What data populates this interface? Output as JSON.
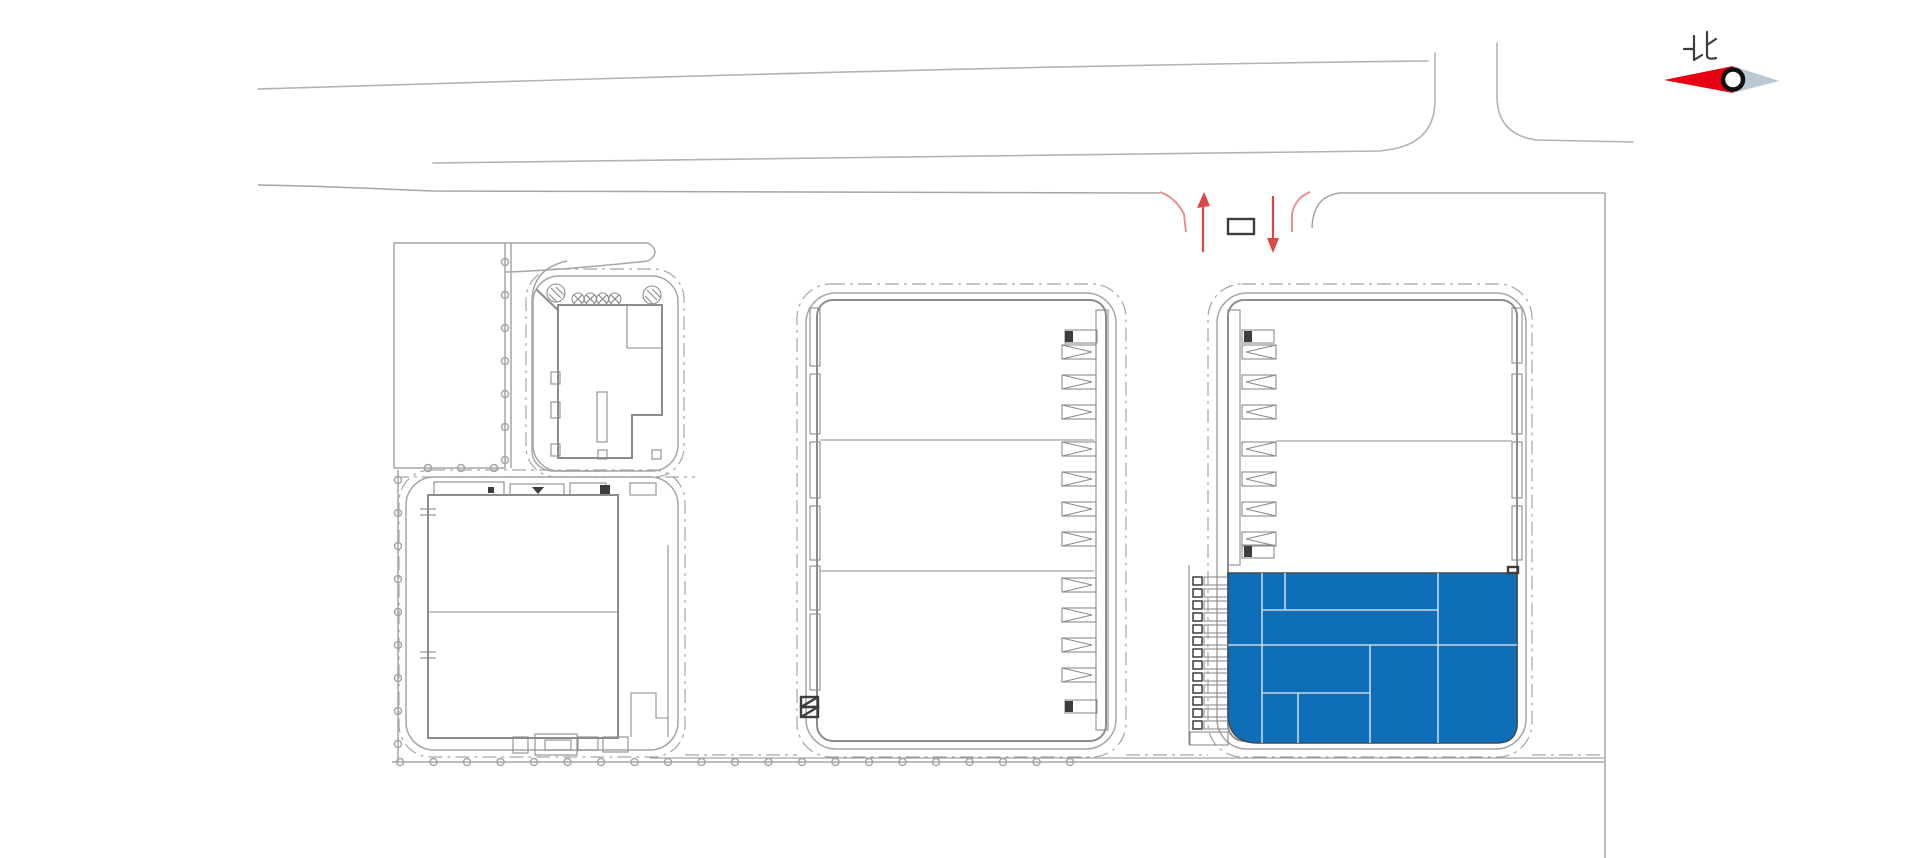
{
  "compass": {
    "north_label": "北"
  },
  "colors": {
    "background": "#ffffff",
    "road_line": "#b3b3b3",
    "boundary_line": "#a6a6a6",
    "wall_line": "#8c8c8c",
    "detail_dark": "#3d3d3d",
    "highlight_fill": "#0e6fb8",
    "highlight_partition": "#c8d8e4",
    "compass_red": "#e60012",
    "compass_gray": "#b9c8d2",
    "entrance_red_arrow": "#d94747",
    "entrance_red_flare": "#ea8f8f"
  },
  "plan": {
    "parking_posts_right": {
      "x": 505,
      "y0": 262,
      "step": 33,
      "count": 7
    },
    "parking_posts_bottom": {
      "y": 468,
      "xs": [
        428,
        461,
        494
      ]
    },
    "left_fence_posts": {
      "x": 398,
      "y0": 480,
      "step": 33,
      "count": 9
    },
    "bottom_fence_posts": {
      "y": 762,
      "x0": 400,
      "step": 33.5,
      "count": 21
    },
    "fans": {
      "y": 299,
      "x0": 578,
      "step": 12.3,
      "count": 4,
      "r": 6
    },
    "mid_wall_strips": [
      [
        810,
        308,
        10,
        58
      ],
      [
        810,
        374,
        10,
        60
      ],
      [
        810,
        442,
        10,
        56
      ],
      [
        810,
        506,
        10,
        54
      ],
      [
        810,
        566,
        10,
        44
      ],
      [
        810,
        614,
        10,
        76
      ]
    ],
    "right_wall_strips": [
      [
        1512,
        308,
        10,
        55
      ],
      [
        1512,
        374,
        10,
        60
      ],
      [
        1512,
        442,
        10,
        56
      ],
      [
        1512,
        506,
        10,
        54
      ]
    ],
    "mid_docks": {
      "x": 1062,
      "w": 34,
      "h": 14,
      "dir": 1,
      "ys": [
        352,
        382,
        412,
        449,
        479,
        509,
        539,
        585,
        615,
        645,
        675
      ]
    },
    "right_docks": {
      "x": 1242,
      "w": 34,
      "h": 14,
      "dir": -1,
      "ys": [
        352,
        382,
        412,
        449,
        479,
        509,
        539
      ]
    },
    "mid_endcaps": [
      [
        1065,
        330
      ],
      [
        1065,
        700
      ]
    ],
    "right_endcaps": [
      [
        1242,
        330
      ],
      [
        1242,
        545
      ]
    ],
    "blue_docks": {
      "x_sq": 1193,
      "x_rect": 1204,
      "y0": 577,
      "step": 12,
      "count": 13
    },
    "blue_partitions": [
      [
        1262,
        573,
        1262,
        743
      ],
      [
        1285,
        573,
        1285,
        610
      ],
      [
        1262,
        610,
        1438,
        610
      ],
      [
        1228,
        645,
        1517,
        645
      ],
      [
        1438,
        573,
        1438,
        743
      ],
      [
        1370,
        645,
        1370,
        743
      ],
      [
        1262,
        693,
        1370,
        693
      ],
      [
        1298,
        693,
        1298,
        743
      ]
    ],
    "small_left_notches": [
      [
        551,
        372,
        9,
        12
      ],
      [
        551,
        402,
        9,
        16
      ],
      [
        551,
        444,
        9,
        12
      ]
    ],
    "small_bottom_ticks": [
      [
        598,
        450,
        9,
        9
      ],
      [
        652,
        450,
        9,
        9
      ]
    ],
    "lower_top_structs": [
      [
        434,
        482,
        70,
        13
      ],
      [
        510,
        484,
        54,
        11
      ],
      [
        570,
        483,
        36,
        12
      ],
      [
        630,
        483,
        26,
        12
      ]
    ],
    "lower_top_darks": [
      [
        600,
        485,
        10,
        9
      ],
      [
        488,
        487,
        6,
        6
      ]
    ],
    "lower_left_ticks_y": [
      509,
      515,
      652,
      658
    ],
    "lower_bottom_structs": [
      [
        513,
        737,
        15,
        16
      ],
      [
        535,
        734,
        42,
        21
      ],
      [
        578,
        737,
        20,
        13
      ],
      [
        603,
        737,
        25,
        15
      ],
      [
        545,
        740,
        26,
        10
      ]
    ],
    "mid_bl_hatch_cells": [
      [
        801,
        697,
        17,
        10
      ],
      [
        801,
        707,
        17,
        10
      ]
    ]
  }
}
